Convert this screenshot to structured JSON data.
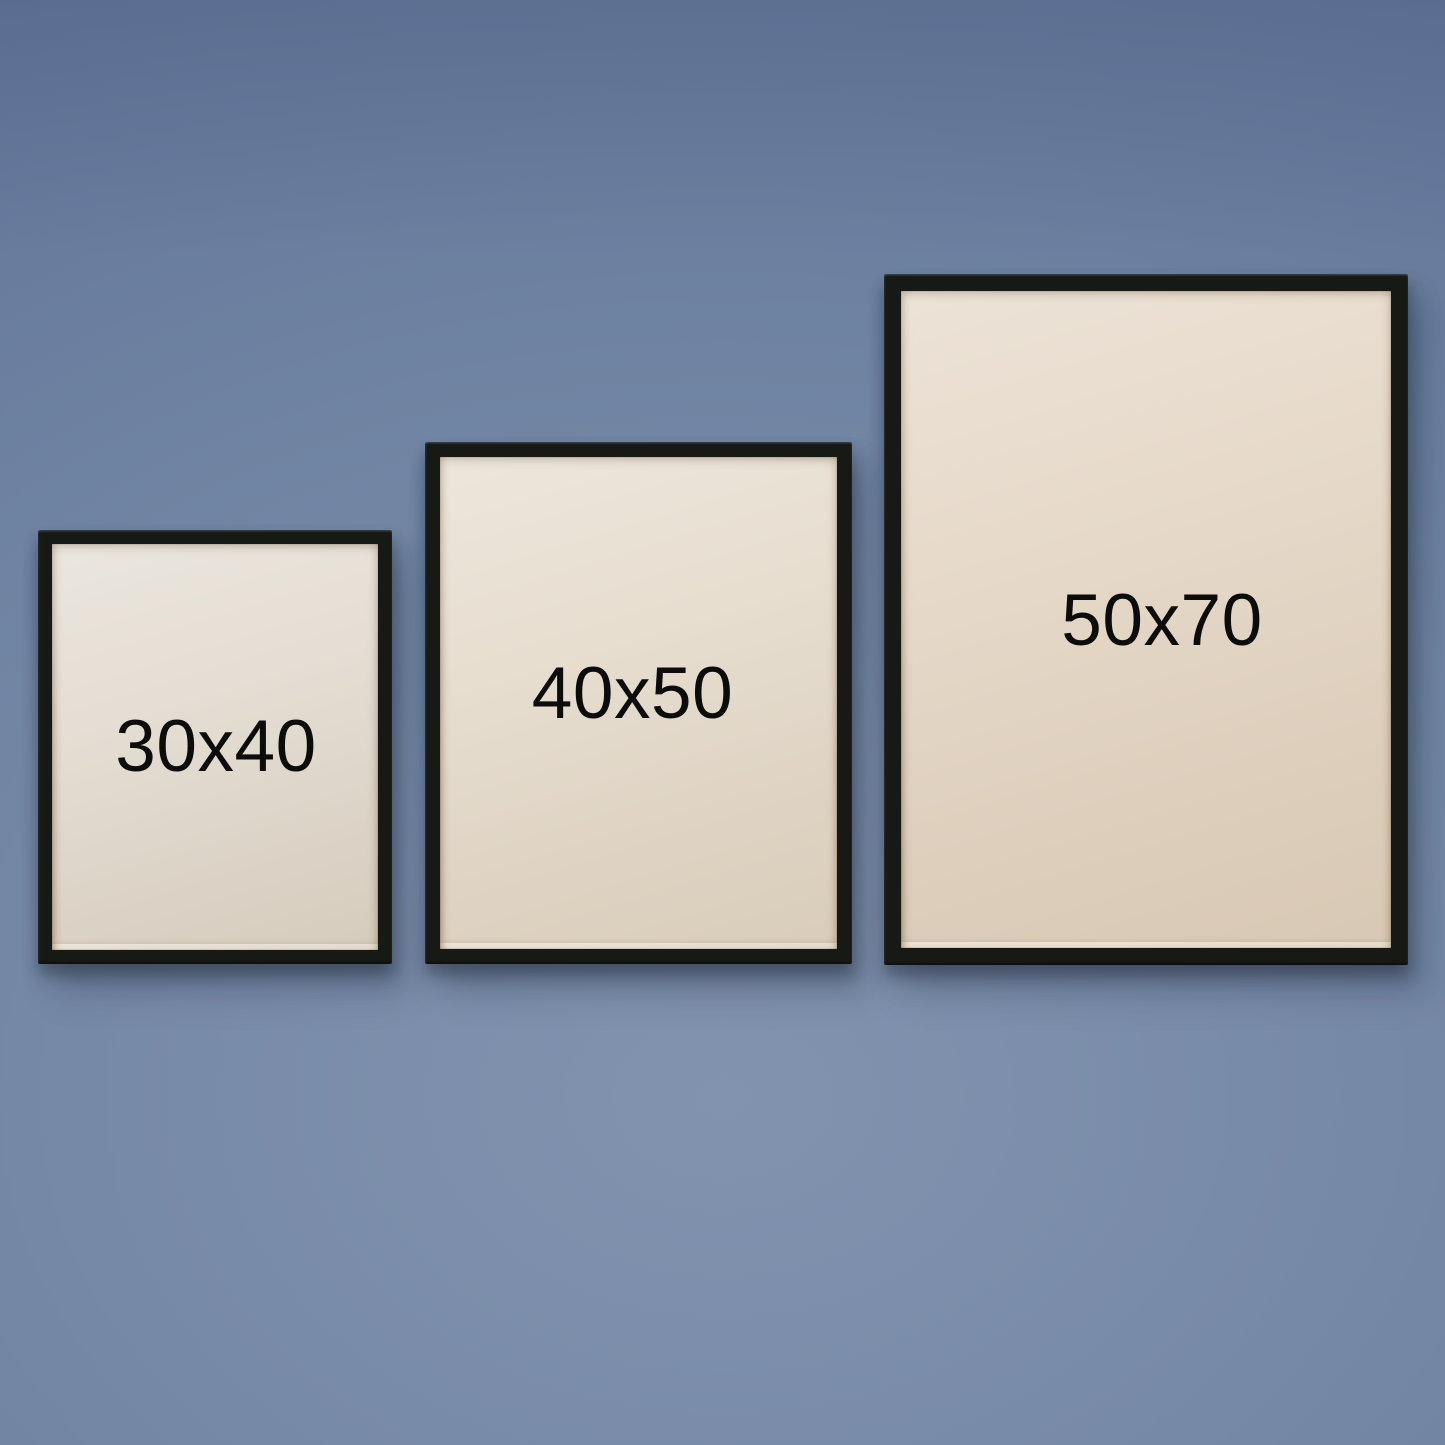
{
  "frames": [
    {
      "id": "frame-30x40",
      "label": "30x40"
    },
    {
      "id": "frame-40x50",
      "label": "40x50"
    },
    {
      "id": "frame-50x70",
      "label": "50x70"
    }
  ],
  "colors": {
    "wall-center": "#8293af",
    "wall-mid": "#7286a4",
    "wall-edge": "#62759a",
    "frame-black": "#171915",
    "paper-1": "#e2dbd0",
    "paper-2": "#e5dbcc",
    "paper-3": "#e4d6c5",
    "label-text": "#0c0c0c"
  }
}
